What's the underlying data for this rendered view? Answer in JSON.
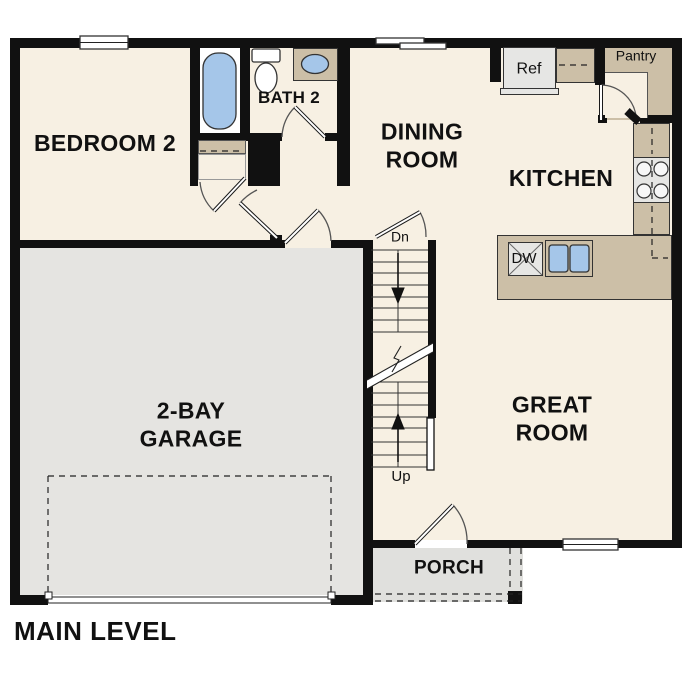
{
  "plan_title": "MAIN LEVEL",
  "rooms": {
    "bedroom2": {
      "label": "BEDROOM 2"
    },
    "bath2": {
      "label": "BATH 2"
    },
    "dining": {
      "line1": "DINING",
      "line2": "ROOM"
    },
    "kitchen": {
      "label": "KITCHEN"
    },
    "great_room": {
      "line1": "GREAT",
      "line2": "ROOM"
    },
    "garage": {
      "line1": "2-BAY",
      "line2": "GARAGE"
    },
    "porch": {
      "label": "PORCH"
    },
    "pantry": {
      "label": "Pantry"
    }
  },
  "appliances": {
    "refrigerator": "Ref",
    "dishwasher": "DW"
  },
  "stairs": {
    "down_label": "Dn",
    "up_label": "Up"
  },
  "colors": {
    "wall": "#111111",
    "floor_cream": "#f7f0e3",
    "floor_garage": "#e5e4e1",
    "floor_porch": "#e0e0dd",
    "counter_tan": "#ccbfa7",
    "fixture_blue": "#a5c6e9",
    "appliance_gray": "#e6e6e4",
    "text": "#111111"
  }
}
